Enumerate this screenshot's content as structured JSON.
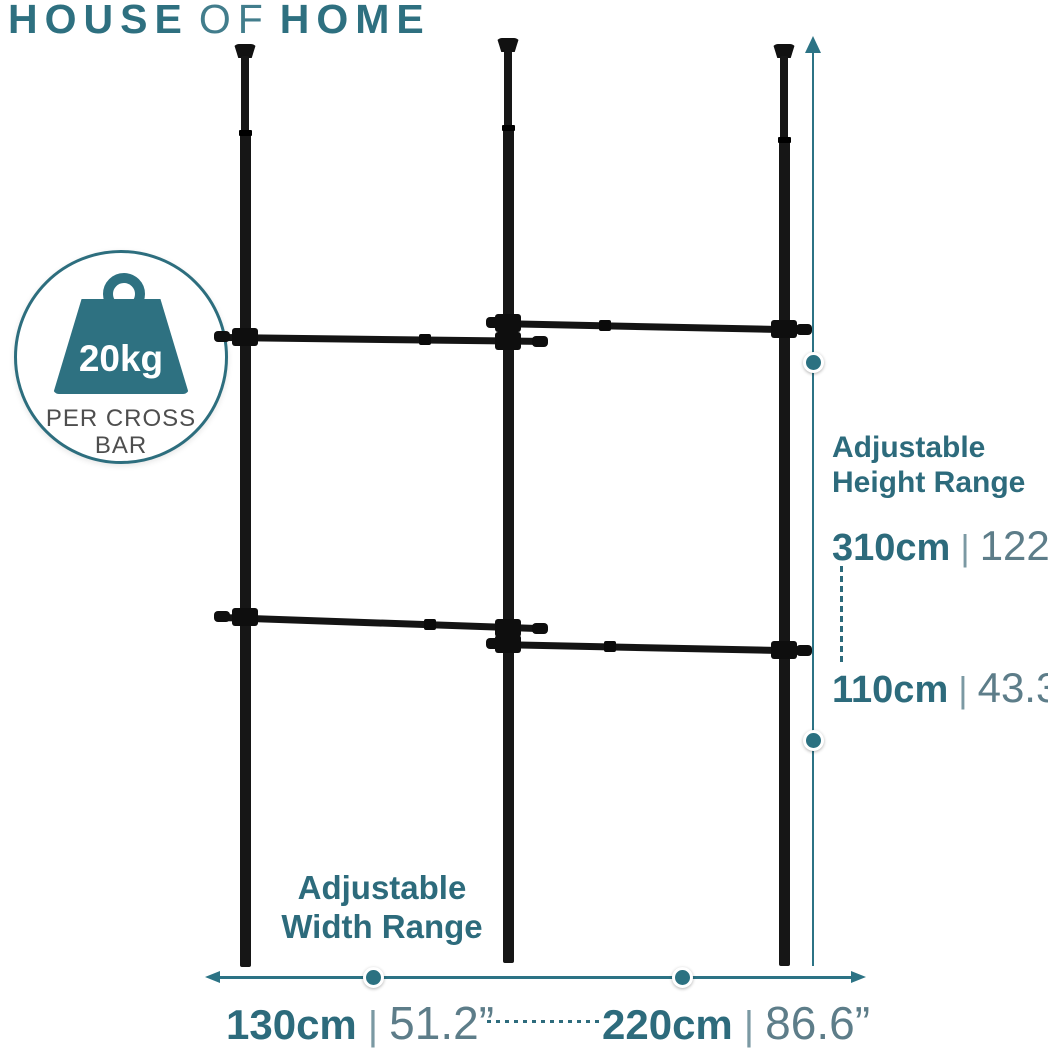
{
  "brand": {
    "word1": "HOUSE",
    "word2": "OF",
    "word3": "HOME"
  },
  "badge": {
    "weight": "20kg",
    "caption_line1": "PER CROSS",
    "caption_line2": "BAR"
  },
  "height_range": {
    "title_line1": "Adjustable",
    "title_line2": "Height Range",
    "max_cm": "310cm",
    "max_in": "122”",
    "min_cm": "110cm",
    "min_in": "43.3”",
    "separator": "|"
  },
  "width_range": {
    "title_line1": "Adjustable",
    "title_line2": "Width Range",
    "left_cm": "130cm",
    "left_in": "51.2”",
    "right_cm": "220cm",
    "right_in": "86.6”",
    "separator": "|"
  },
  "icons": {
    "weight": "weight-icon",
    "height_arrow": "vertical-measure-arrow-icon",
    "width_arrow": "horizontal-measure-arrow-icon"
  },
  "colors": {
    "teal_text": "#2d6b7c",
    "teal_logo": "#2e7080",
    "teal_icon": "#2e7181",
    "arrow": "#2c7385",
    "inch_text": "#5d7d89",
    "pole_black": "#161616",
    "caption_gray": "#4e4e4e",
    "background": "#ffffff"
  }
}
